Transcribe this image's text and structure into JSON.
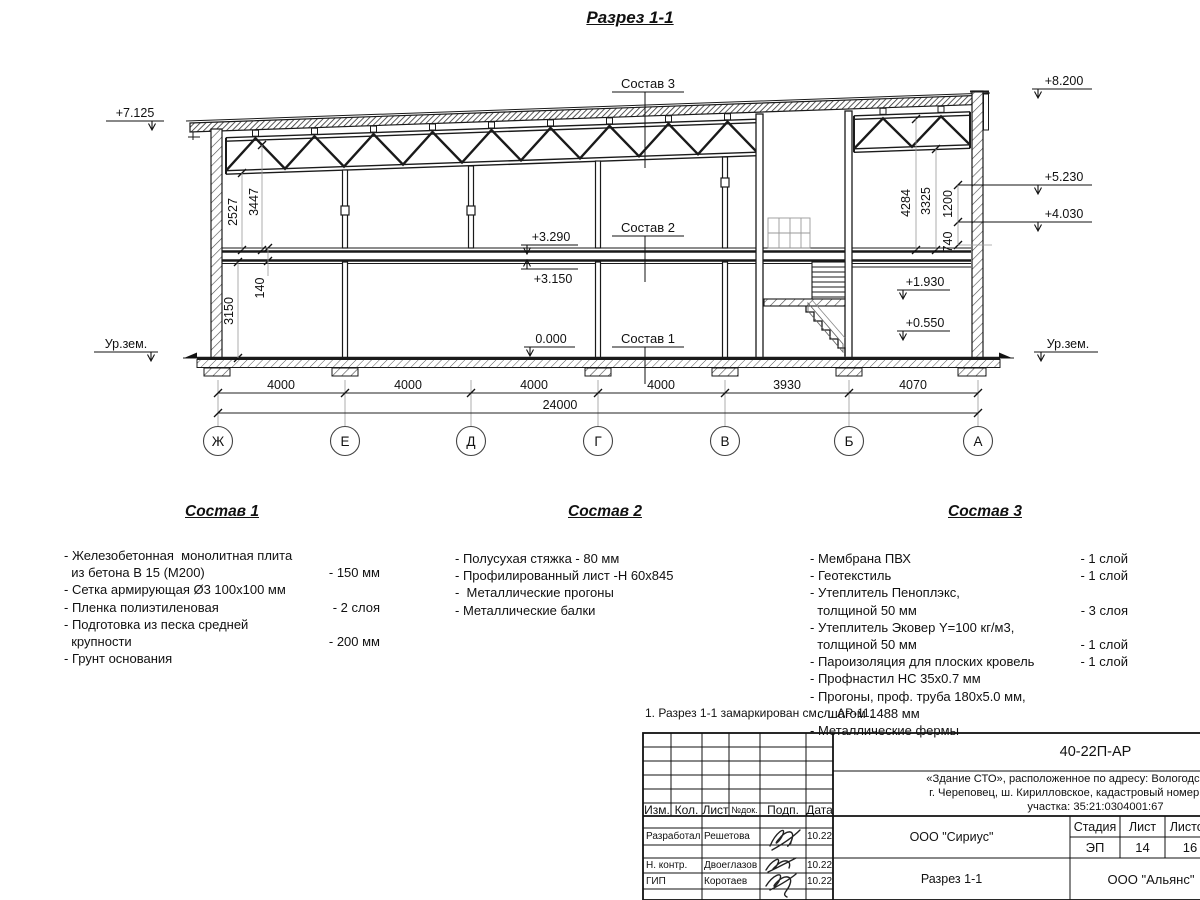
{
  "title": "Разрез 1-1",
  "drawing": {
    "elevations": {
      "roof_left": "+7.125",
      "parapet_top": "+8.200",
      "level_5230": "+5.230",
      "level_4030": "+4.030",
      "floor_top": "+3.290",
      "floor_bottom": "+3.150",
      "zero": "0.000",
      "stair_landing": "+1.930",
      "stair_low": "+0.550",
      "ground_left": "Ур.зем.",
      "ground_right": "Ур.зем."
    },
    "leaders": {
      "sostav1": "Состав 1",
      "sostav2": "Состав 2",
      "sostav3": "Состав 3"
    },
    "vertical_dims": {
      "left_truss": "2527",
      "left_roof": "3447",
      "floor_thickness": "140",
      "ground_floor": "3150",
      "right_total": "4284",
      "right_truss": "3325",
      "right_upper": "1200",
      "right_parapet": "740"
    },
    "horizontal_dims": {
      "spans": [
        "4000",
        "4000",
        "4000",
        "4000",
        "3930",
        "4070"
      ],
      "total": "24000"
    },
    "axes": [
      "Ж",
      "Е",
      "Д",
      "Г",
      "В",
      "Б",
      "А"
    ]
  },
  "compositions": [
    {
      "title": "Состав 1",
      "items": [
        {
          "text": "- Железобетонная  монолитная плита\n  из бетона В 15 (М200)",
          "value": "- 150 мм"
        },
        {
          "text": "- Сетка армирующая Ø3 100х100 мм",
          "value": ""
        },
        {
          "text": "- Пленка полиэтиленовая",
          "value": "-  2 слоя"
        },
        {
          "text": "- Подготовка из песка средней\n  крупности",
          "value": "- 200 мм"
        },
        {
          "text": "- Грунт основания",
          "value": ""
        }
      ]
    },
    {
      "title": "Состав 2",
      "items": [
        {
          "text": "- Полусухая стяжка - 80 мм",
          "value": ""
        },
        {
          "text": "- Профилированный лист -Н 60х845",
          "value": ""
        },
        {
          "text": "-  Металлические прогоны",
          "value": ""
        },
        {
          "text": "- Металлические балки",
          "value": ""
        }
      ]
    },
    {
      "title": "Состав 3",
      "items": [
        {
          "text": "- Мембрана ПВХ",
          "value": "- 1 слой"
        },
        {
          "text": "- Геотекстиль",
          "value": "- 1 слой"
        },
        {
          "text": "- Утеплитель Пеноплэкс,\n  толщиной 50 мм",
          "value": "- 3 слоя"
        },
        {
          "text": "- Утеплитель Эковер Y=100 кг/м3,\n  толщиной 50 мм",
          "value": "- 1 слой"
        },
        {
          "text": "- Пароизоляция для плоских кровель",
          "value": "- 1 слой"
        },
        {
          "text": "- Профнастил НС 35х0.7 мм",
          "value": ""
        },
        {
          "text": "- Прогоны, проф. труба 180х5.0 мм,\n  с шагом 1488 мм",
          "value": ""
        },
        {
          "text": "- Металлические фермы",
          "value": ""
        }
      ]
    }
  ],
  "note": "1. Разрез 1-1 замаркирован см. л. АР-11.",
  "titleblock": {
    "doc_number": "40-22П-АР",
    "project_description": "«Здание СТО», расположенное по адресу: Вологодская область,\nг. Череповец, ш. Кирилловское, кадастровый номер земельного\nучастка: 35:21:0304001:67",
    "columns": [
      "Изм.",
      "Кол.",
      "Лист",
      "№док.",
      "Подп.",
      "Дата"
    ],
    "rows": [
      {
        "role": "Разработал",
        "name": "Решетова",
        "date": "10.22"
      },
      {
        "role": "Н. контр.",
        "name": "Двоеглазов",
        "date": "10.22"
      },
      {
        "role": "ГИП",
        "name": "Коротаев",
        "date": "10.22"
      }
    ],
    "organization": "ООО \"Сириус\"",
    "sheet_title": "Разрез 1-1",
    "stage_label": "Стадия",
    "sheet_label": "Лист",
    "sheets_label": "Листов",
    "stage": "ЭП",
    "sheet_number": "14",
    "sheets_total": "16",
    "company": "ООО \"Альянс\""
  }
}
